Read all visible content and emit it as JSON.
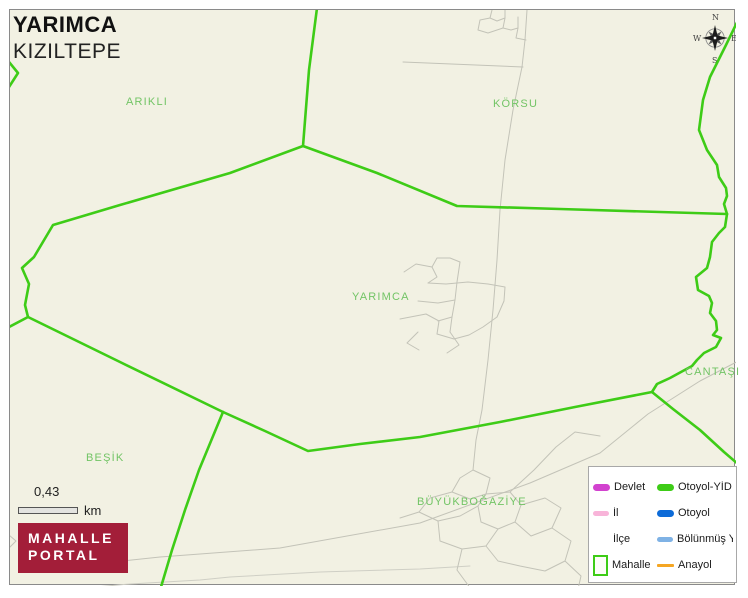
{
  "header": {
    "title": "YARIMCA",
    "subtitle": "KIZILTEPE"
  },
  "compass": {
    "north": "N",
    "east": "E",
    "south": "S",
    "west": "W"
  },
  "map_labels": {
    "arikli": "ARIKLI",
    "korsu": "KÖRSU",
    "yarimca": "YARIMCA",
    "cantasi": "CANTAŞI",
    "besik": "BEŞİK",
    "buyukbogaziye": "BÜYÜKBOĞAZİYE"
  },
  "scale_bar": {
    "value": "0,43",
    "unit": "km"
  },
  "logo": {
    "line1": "MAHALLE",
    "line2": "PORTAL"
  },
  "legend": {
    "items": [
      {
        "label": "Devlet",
        "swatch": "line-thick",
        "color": "#d242cf"
      },
      {
        "label": "Otoyol-YİD",
        "swatch": "line-thick",
        "color": "#3ecc17"
      },
      {
        "label": "İl",
        "swatch": "line-medium",
        "color": "#f8b4d9"
      },
      {
        "label": "Otoyol",
        "swatch": "line-thick",
        "color": "#0d6bd8"
      },
      {
        "label": "İlçe",
        "swatch": "line-none",
        "color": "#ffffff"
      },
      {
        "label": "Bölünmüş Y",
        "swatch": "line-medium",
        "color": "#7fb2e5"
      },
      {
        "label": "Mahalle",
        "swatch": "box",
        "color": "#3ecc17"
      },
      {
        "label": "Anayol",
        "swatch": "line-thin",
        "color": "#f5a623"
      }
    ]
  },
  "colors": {
    "map-bg": "#f2f1e3",
    "boundary-green": "#3ecc17",
    "label-green": "#72c465",
    "road-gray": "#c3c3b8",
    "frame-gray": "#8a8a8a",
    "logo-red": "#a31e39"
  }
}
